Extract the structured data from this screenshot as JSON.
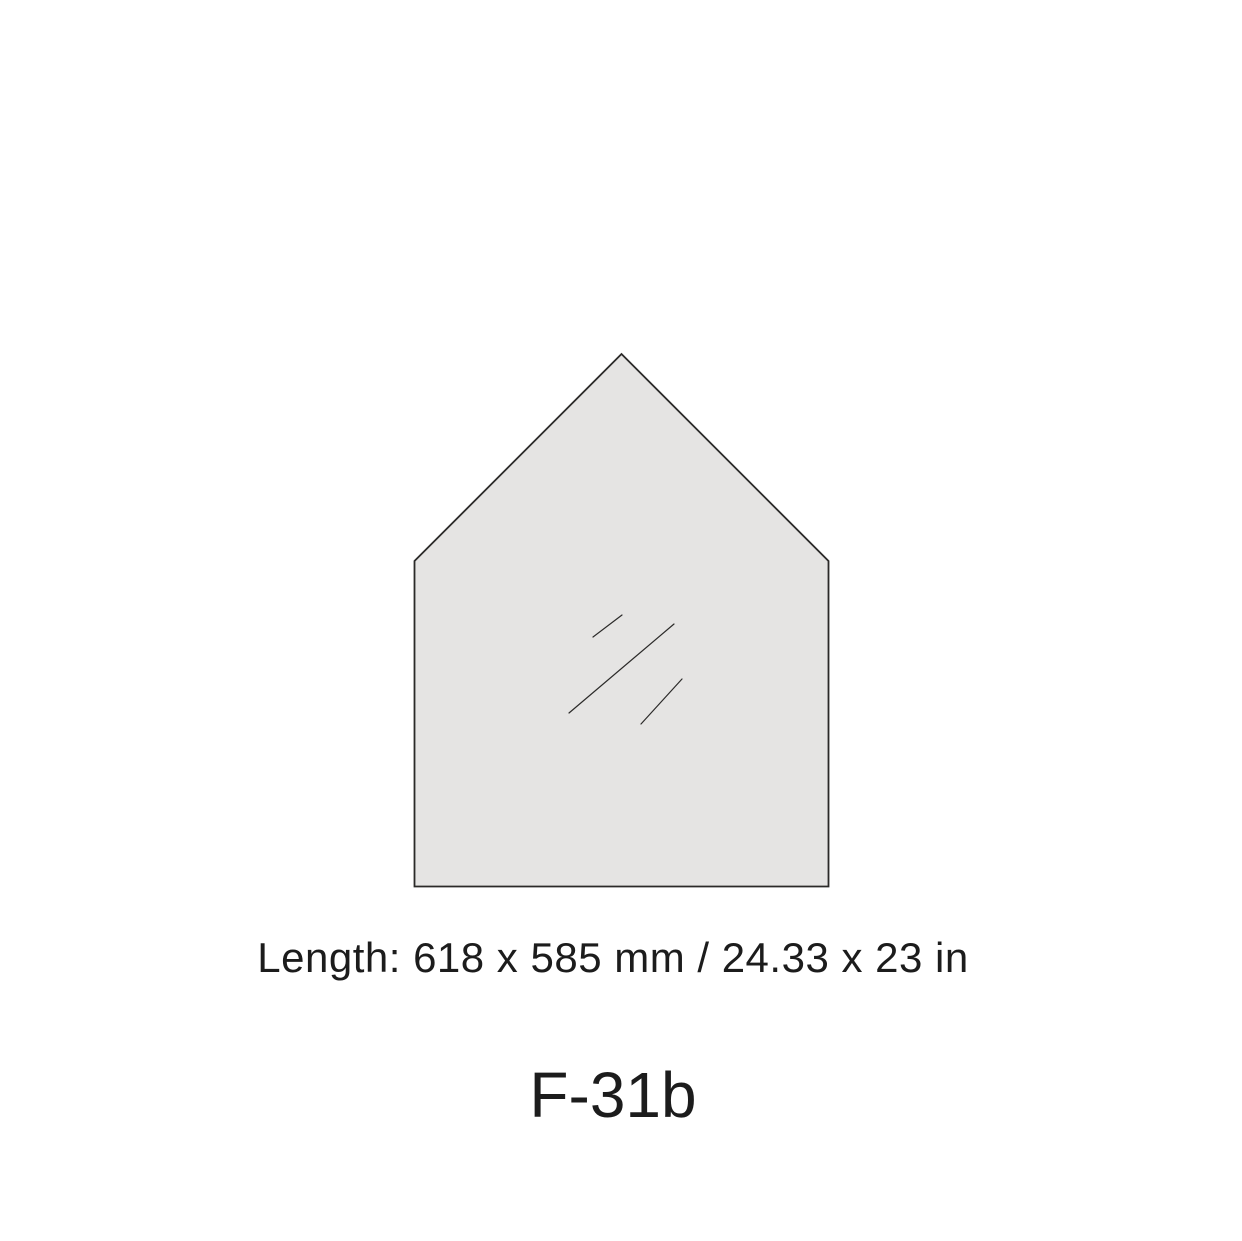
{
  "figure": {
    "shape": {
      "name": "house-shaped glass panel",
      "fill": "#e5e4e3",
      "stroke": "#2b2a29",
      "stroke_width": "1.8",
      "points": "414.5,886.5 414.5,561 621.5,354 828.5,561 828.5,886.5",
      "shine_lines": [
        {
          "x1": 593,
          "y1": 637,
          "x2": 622,
          "y2": 615
        },
        {
          "x1": 569,
          "y1": 713,
          "x2": 674,
          "y2": 624
        },
        {
          "x1": 641,
          "y1": 724,
          "x2": 682,
          "y2": 679
        }
      ],
      "shine_stroke": "#2b2a29",
      "shine_stroke_width": "1.2"
    },
    "dimension_label": "Length: 618 x 585 mm / 24.33 x 23 in",
    "title": "F-31b"
  }
}
